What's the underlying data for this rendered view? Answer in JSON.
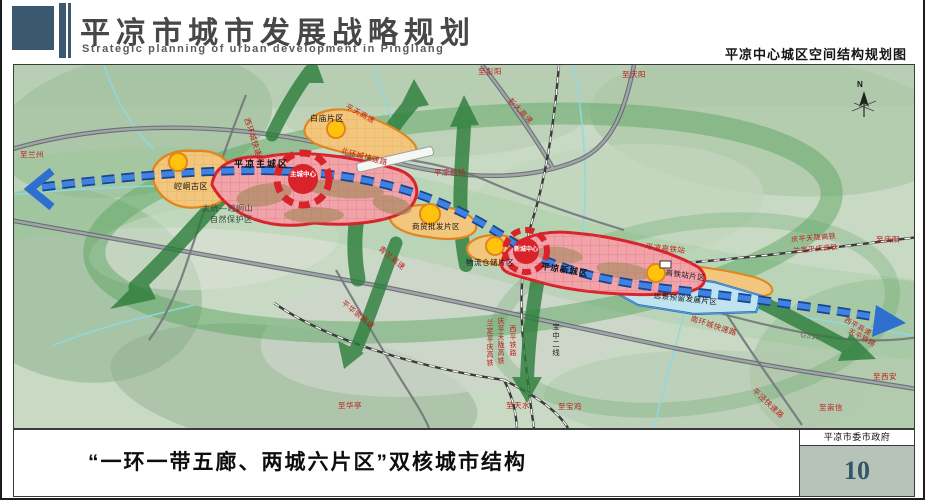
{
  "header": {
    "title_cn": "平凉市城市发展战略规划",
    "title_en": "Strategic planning of urban development in Pingliang",
    "map_subtitle": "平凉中心城区空间结构规划图"
  },
  "footer": {
    "caption": "“一环一带五廊、两城六片区”双核城市结构",
    "agency": "平凉市委市政府",
    "page_number": "10"
  },
  "map": {
    "compass_label": "N",
    "colors": {
      "core_red": "#d8232a",
      "zone_pink": "#f2a3aa",
      "zone_orange": "#f2c67c",
      "zone_blue": "#bfe4f0",
      "axis_blue": "#2e6fd0",
      "corridor_green": "#2c7d3b",
      "subcenter_yellow": "#ffc30e"
    },
    "zones": {
      "main_city": "平凉主城区",
      "new_city": "平凉新城区",
      "main_center": "主城中心",
      "new_center": "新城中心",
      "kongtong": "崆峒古区",
      "baimiao": "白庙片区",
      "trade": "商贸批发片区",
      "logistics": "物流仓储片区",
      "hsr_district": "高铁站片区",
      "reserved": "远景预留发展片区"
    },
    "landmarks": {
      "airport": "平凉机场",
      "hsr_station": "平凉高铁站",
      "nature_reserve_1": "太统—崆峒山",
      "nature_reserve_2": "自然保护区"
    },
    "roads": {
      "pingtian_expwy": "平天高速",
      "pengda_expwy": "彭大高速",
      "qinglan_expwy": "青兰高速",
      "north_ring": "北环城快速路",
      "west_ring": "西环城快速路",
      "south_ring": "南环城快速路",
      "pinghuachong_expwy": "平华崇高速",
      "pingjing_expwy": "平泾快速路",
      "g312": "G312",
      "xiping_corridor_1": "西平高速",
      "xiping_corridor_2": "天平铁路"
    },
    "railways": {
      "qptl_hsr": "庆平天陇高铁",
      "ldpq_hsr": "兰定平庆高铁",
      "xiping_rail": "西平铁路",
      "baozhong_2": "宝中二线"
    },
    "directions": {
      "lanzhou": "至兰州",
      "pengyang": "至彭阳",
      "qingyang_top": "至庆阳",
      "qingyang_right": "至庆阳",
      "xian": "至西安",
      "chongxin": "至崇信",
      "huating": "至华亭",
      "tianshui": "至天水",
      "baoji": "至宝鸡"
    }
  }
}
